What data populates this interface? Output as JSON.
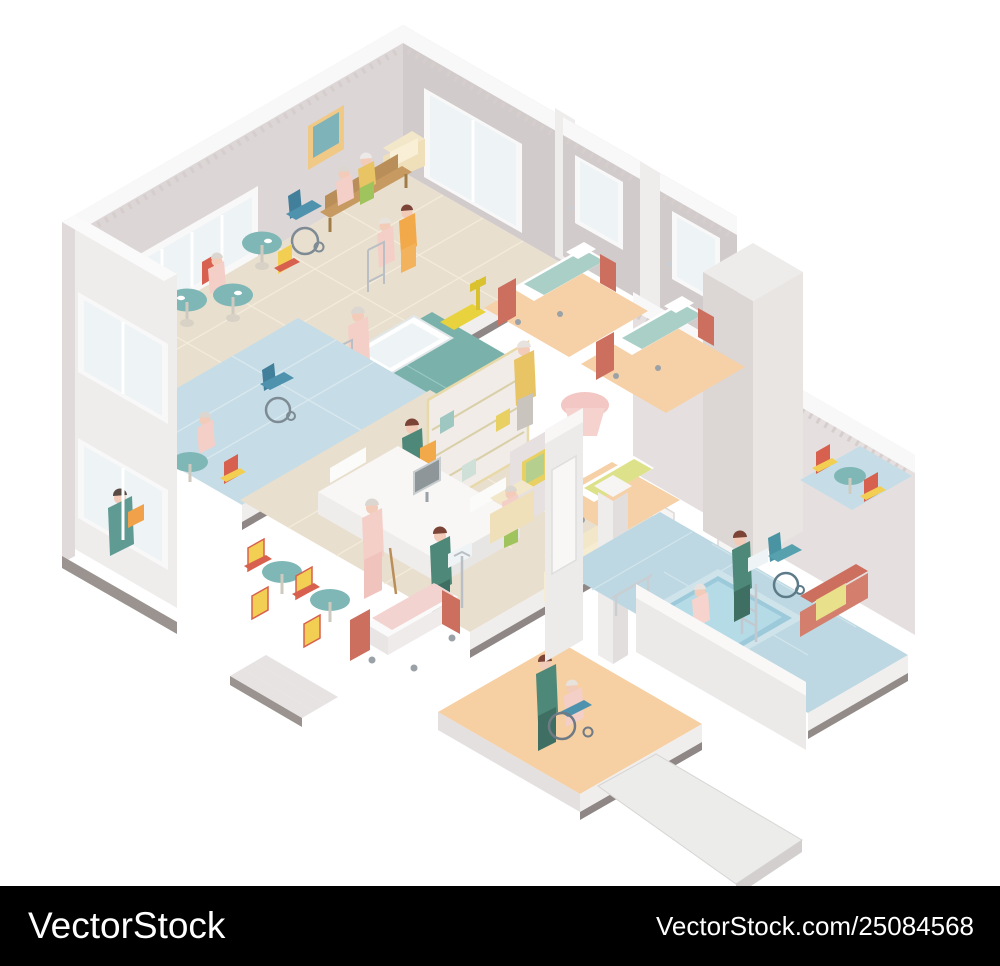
{
  "page": {
    "width": 1000,
    "height": 966,
    "background": "#ffffff"
  },
  "watermark_bar": {
    "background": "#000000",
    "text_color": "#ffffff",
    "logo_text": "VectorStock",
    "credit_text": "VectorStock.com/25084568"
  },
  "illustration": {
    "name": "nursing-home-isometric-cutaway",
    "palette": {
      "wall": "#ddd6d6",
      "wall_shadow": "#d2cbcb",
      "wall_light": "#efecec",
      "floor_tile_beige": "#e9dfce",
      "floor_blue": "#c6dde7",
      "floor_peach": "#f6d0a6",
      "floor_orange": "#f6cfa2",
      "bathroom_teal": "#7ab1ab",
      "pool_water": "#9ccadb",
      "pool_tile": "#bdd8e2",
      "accent_coral": "#cd6f5f",
      "accent_teal": "#7fb7b6",
      "accent_red": "#d8604e",
      "accent_yellow": "#f2cf52",
      "cream": "#f3e7c9",
      "wood": "#b98e58",
      "scrubs_green": "#4e8878",
      "scrubs_orange": "#f1a94a",
      "elder_pink": "#f4cfc8",
      "base_gray": "#8e8785"
    },
    "scene_elements": [
      "common-room",
      "dining-tables",
      "wooden-bench",
      "armchair",
      "wheelchairs",
      "nurse-with-walker-patient",
      "reading-woman-window",
      "bathroom-with-tub-and-lift",
      "reception-desk",
      "nurse-receptionist",
      "shelving-unit",
      "computer-monitor",
      "elderly-man-with-cane",
      "nurse-with-linens",
      "cream-sofa",
      "bedrooms-with-beds",
      "elderly-man-yellow-cardigan",
      "hospital-bed-with-iv-stand",
      "hydrotherapy-pool",
      "pool-ladder",
      "elderly-man-in-pool",
      "nurse-with-towel",
      "coral-sofa",
      "nurse-pushing-wheelchair",
      "entrance-ramp",
      "steps",
      "elevator-shaft"
    ]
  }
}
